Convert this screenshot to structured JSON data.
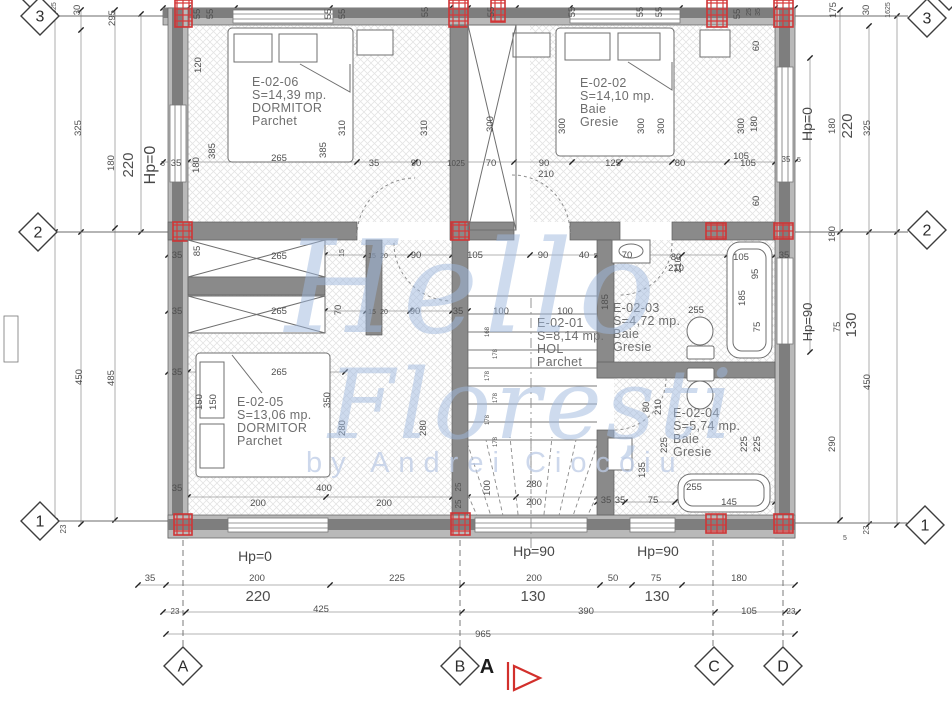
{
  "watermark": {
    "line1": "Hello",
    "line2": "Florești",
    "line3": "by Andrei Ciocoiu",
    "color": "#9db8dd",
    "byline_color": "#bccbe6"
  },
  "section_marker": {
    "label": "A",
    "color": "#d2302c"
  },
  "rooms": [
    {
      "id": "E-02-06",
      "area": "S=14,39 mp.",
      "name": "DORMITOR",
      "finish": "Parchet",
      "x": 252,
      "y": 86
    },
    {
      "id": "E-02-02",
      "area": "S=14,10 mp.",
      "name": "Baie",
      "finish": "Gresie",
      "x": 580,
      "y": 87
    },
    {
      "id": "E-02-01",
      "area": "S=8,14 mp.",
      "name": "HOL",
      "finish": "Parchet",
      "x": 537,
      "y": 327
    },
    {
      "id": "E-02-03",
      "area": "S=4,72 mp.",
      "name": "Baie",
      "finish": "Gresie",
      "x": 613,
      "y": 312
    },
    {
      "id": "E-02-05",
      "area": "S=13,06 mp.",
      "name": "DORMITOR",
      "finish": "Parchet",
      "x": 237,
      "y": 406
    },
    {
      "id": "E-02-04",
      "area": "S=5,74 mp.",
      "name": "Baie",
      "finish": "Gresie",
      "x": 673,
      "y": 417
    }
  ],
  "grid_bubbles": [
    {
      "label": "4",
      "x": 33,
      "y": -9
    },
    {
      "label": "3",
      "x": 40,
      "y": 16
    },
    {
      "label": "2",
      "x": 38,
      "y": 232
    },
    {
      "label": "1",
      "x": 40,
      "y": 521
    },
    {
      "label": "4",
      "x": 949,
      "y": -9
    },
    {
      "label": "3",
      "x": 927,
      "y": 18
    },
    {
      "label": "2",
      "x": 927,
      "y": 230
    },
    {
      "label": "1",
      "x": 925,
      "y": 525
    },
    {
      "label": "A",
      "x": 183,
      "y": 666
    },
    {
      "label": "B",
      "x": 460,
      "y": 666
    },
    {
      "label": "C",
      "x": 714,
      "y": 666
    },
    {
      "label": "D",
      "x": 783,
      "y": 666
    }
  ],
  "hp_labels": [
    [
      "Hp=0",
      155,
      165,
      -90,
      16
    ],
    [
      "Hp=0",
      812,
      124,
      -90,
      14
    ],
    [
      "Hp=90",
      812,
      322,
      -90,
      13
    ],
    [
      "Hp=0",
      255,
      561,
      0,
      14
    ],
    [
      "Hp=90",
      534,
      556,
      0,
      14
    ],
    [
      "Hp=90",
      658,
      556,
      0,
      14
    ]
  ],
  "dims": [
    [
      "55",
      200,
      14,
      -90
    ],
    [
      "55",
      213,
      14,
      -90
    ],
    [
      "55",
      331,
      14,
      -90
    ],
    [
      "55",
      345,
      14,
      -90
    ],
    [
      "55",
      428,
      12,
      -90
    ],
    [
      "55",
      494,
      12,
      -90
    ],
    [
      "55",
      575,
      12,
      -90
    ],
    [
      "55",
      643,
      12,
      -90
    ],
    [
      "55",
      662,
      12,
      -90
    ],
    [
      "55",
      740,
      14,
      -90
    ],
    [
      "25",
      751,
      12,
      -90,
      7
    ],
    [
      "35",
      760,
      12,
      -90,
      7
    ],
    [
      "1625",
      56,
      10,
      -90,
      7
    ],
    [
      "30",
      80,
      10,
      -90
    ],
    [
      "295",
      115,
      18,
      -90
    ],
    [
      "175",
      836,
      10,
      -90
    ],
    [
      "30",
      869,
      10,
      -90
    ],
    [
      "1625",
      890,
      10,
      -90,
      7
    ],
    [
      "325",
      81,
      128,
      -90
    ],
    [
      "180",
      114,
      163,
      -90
    ],
    [
      "220",
      133,
      165,
      -90,
      15
    ],
    [
      "450",
      82,
      377,
      -90
    ],
    [
      "485",
      114,
      378,
      -90
    ],
    [
      "23",
      66,
      529,
      -90,
      8
    ],
    [
      "60",
      759,
      46,
      -90
    ],
    [
      "180",
      757,
      124,
      -90
    ],
    [
      "300",
      744,
      126,
      -90
    ],
    [
      "105",
      741,
      159
    ],
    [
      "35",
      786,
      162,
      0,
      8
    ],
    [
      "5",
      799,
      162,
      0,
      7
    ],
    [
      "60",
      759,
      201,
      -90
    ],
    [
      "180",
      835,
      126,
      -90
    ],
    [
      "220",
      852,
      126,
      -90,
      15
    ],
    [
      "325",
      870,
      128,
      -90
    ],
    [
      "180",
      835,
      234,
      -90
    ],
    [
      "75",
      840,
      327,
      -90
    ],
    [
      "130",
      856,
      325,
      -90,
      15
    ],
    [
      "450",
      870,
      382,
      -90
    ],
    [
      "290",
      835,
      444,
      -90
    ],
    [
      "23",
      869,
      530,
      -90,
      8
    ],
    [
      "5",
      845,
      540,
      0,
      7
    ],
    [
      "5",
      163,
      166,
      0,
      7
    ],
    [
      "35",
      176,
      166
    ],
    [
      "180",
      199,
      165,
      -90
    ],
    [
      "120",
      201,
      65,
      -90
    ],
    [
      "385",
      215,
      151,
      -90
    ],
    [
      "265",
      279,
      161
    ],
    [
      "310",
      345,
      128,
      -90
    ],
    [
      "385",
      326,
      150,
      -90
    ],
    [
      "310",
      427,
      128,
      -90
    ],
    [
      "35",
      374,
      166
    ],
    [
      "90",
      416,
      166
    ],
    [
      "1025",
      456,
      166,
      0,
      8
    ],
    [
      "70",
      491,
      166
    ],
    [
      "90",
      544,
      166
    ],
    [
      "210",
      546,
      177
    ],
    [
      "125",
      613,
      166
    ],
    [
      "80",
      680,
      166
    ],
    [
      "105",
      748,
      166
    ],
    [
      "300",
      493,
      124,
      -90
    ],
    [
      "300",
      565,
      126,
      -90
    ],
    [
      "300",
      644,
      126,
      -90
    ],
    [
      "300",
      664,
      126,
      -90
    ],
    [
      "35",
      177,
      258
    ],
    [
      "85",
      200,
      251,
      -90
    ],
    [
      "265",
      279,
      259
    ],
    [
      "15",
      344,
      253,
      -90,
      7
    ],
    [
      "15",
      372,
      258,
      0,
      7
    ],
    [
      "20",
      384,
      258,
      0,
      7
    ],
    [
      "90",
      416,
      258
    ],
    [
      "105",
      475,
      258
    ],
    [
      "90",
      543,
      258
    ],
    [
      "40",
      584,
      258
    ],
    [
      "5",
      596,
      258,
      0,
      7
    ],
    [
      "70",
      627,
      258
    ],
    [
      "80",
      676,
      260
    ],
    [
      "210",
      676,
      271
    ],
    [
      "255",
      696,
      313
    ],
    [
      "105",
      741,
      260
    ],
    [
      "95",
      758,
      274,
      -90
    ],
    [
      "185",
      745,
      298,
      -90
    ],
    [
      "75",
      760,
      327,
      -90
    ],
    [
      "35",
      784,
      258
    ],
    [
      "35",
      177,
      314
    ],
    [
      "265",
      279,
      314
    ],
    [
      "70",
      341,
      310,
      -90
    ],
    [
      "15",
      372,
      314,
      0,
      7
    ],
    [
      "20",
      384,
      314,
      0,
      7
    ],
    [
      "90",
      415,
      314
    ],
    [
      "35",
      458,
      314
    ],
    [
      "100",
      501,
      314
    ],
    [
      "100",
      565,
      314
    ],
    [
      "185",
      608,
      302,
      -90
    ],
    [
      "210",
      681,
      265,
      -90
    ],
    [
      "35",
      177,
      375
    ],
    [
      "265",
      279,
      375
    ],
    [
      "350",
      330,
      400,
      -90
    ],
    [
      "280",
      345,
      428,
      -90
    ],
    [
      "150",
      202,
      402,
      -90
    ],
    [
      "150",
      216,
      402,
      -90
    ],
    [
      "400",
      324,
      491
    ],
    [
      "200",
      258,
      506
    ],
    [
      "200",
      384,
      506
    ],
    [
      "35",
      177,
      491
    ],
    [
      "280",
      426,
      428,
      -90
    ],
    [
      "25",
      461,
      487,
      -90,
      8
    ],
    [
      "25",
      461,
      504,
      -90,
      8
    ],
    [
      "100",
      490,
      488,
      -90
    ],
    [
      "280",
      534,
      487
    ],
    [
      "200",
      534,
      505
    ],
    [
      "168",
      489,
      332,
      -90,
      6
    ],
    [
      "178",
      497,
      354,
      -90,
      6
    ],
    [
      "178",
      489,
      376,
      -90,
      6
    ],
    [
      "178",
      497,
      398,
      -90,
      6
    ],
    [
      "178",
      489,
      420,
      -90,
      6
    ],
    [
      "178",
      497,
      442,
      -90,
      6
    ],
    [
      "135",
      645,
      470,
      -90
    ],
    [
      "225",
      667,
      445,
      -90
    ],
    [
      "225",
      747,
      444,
      -90
    ],
    [
      "225",
      760,
      444,
      -90
    ],
    [
      "80",
      649,
      407,
      -90
    ],
    [
      "210",
      661,
      407,
      -90
    ],
    [
      "35",
      606,
      503
    ],
    [
      "35",
      620,
      503
    ],
    [
      "75",
      653,
      503
    ],
    [
      "255",
      694,
      490
    ],
    [
      "145",
      729,
      505
    ],
    [
      "35",
      150,
      581
    ],
    [
      "200",
      257,
      581
    ],
    [
      "225",
      397,
      581
    ],
    [
      "200",
      534,
      581
    ],
    [
      "50",
      613,
      581
    ],
    [
      "75",
      656,
      581
    ],
    [
      "180",
      739,
      581
    ],
    [
      "220",
      258,
      601,
      0,
      15
    ],
    [
      "130",
      533,
      601,
      0,
      15
    ],
    [
      "130",
      657,
      601,
      0,
      15
    ],
    [
      "23",
      175,
      614,
      0,
      8
    ],
    [
      "425",
      321,
      612
    ],
    [
      "390",
      586,
      614
    ],
    [
      "105",
      749,
      614
    ],
    [
      "23",
      791,
      614,
      0,
      8
    ],
    [
      "965",
      483,
      637
    ]
  ]
}
